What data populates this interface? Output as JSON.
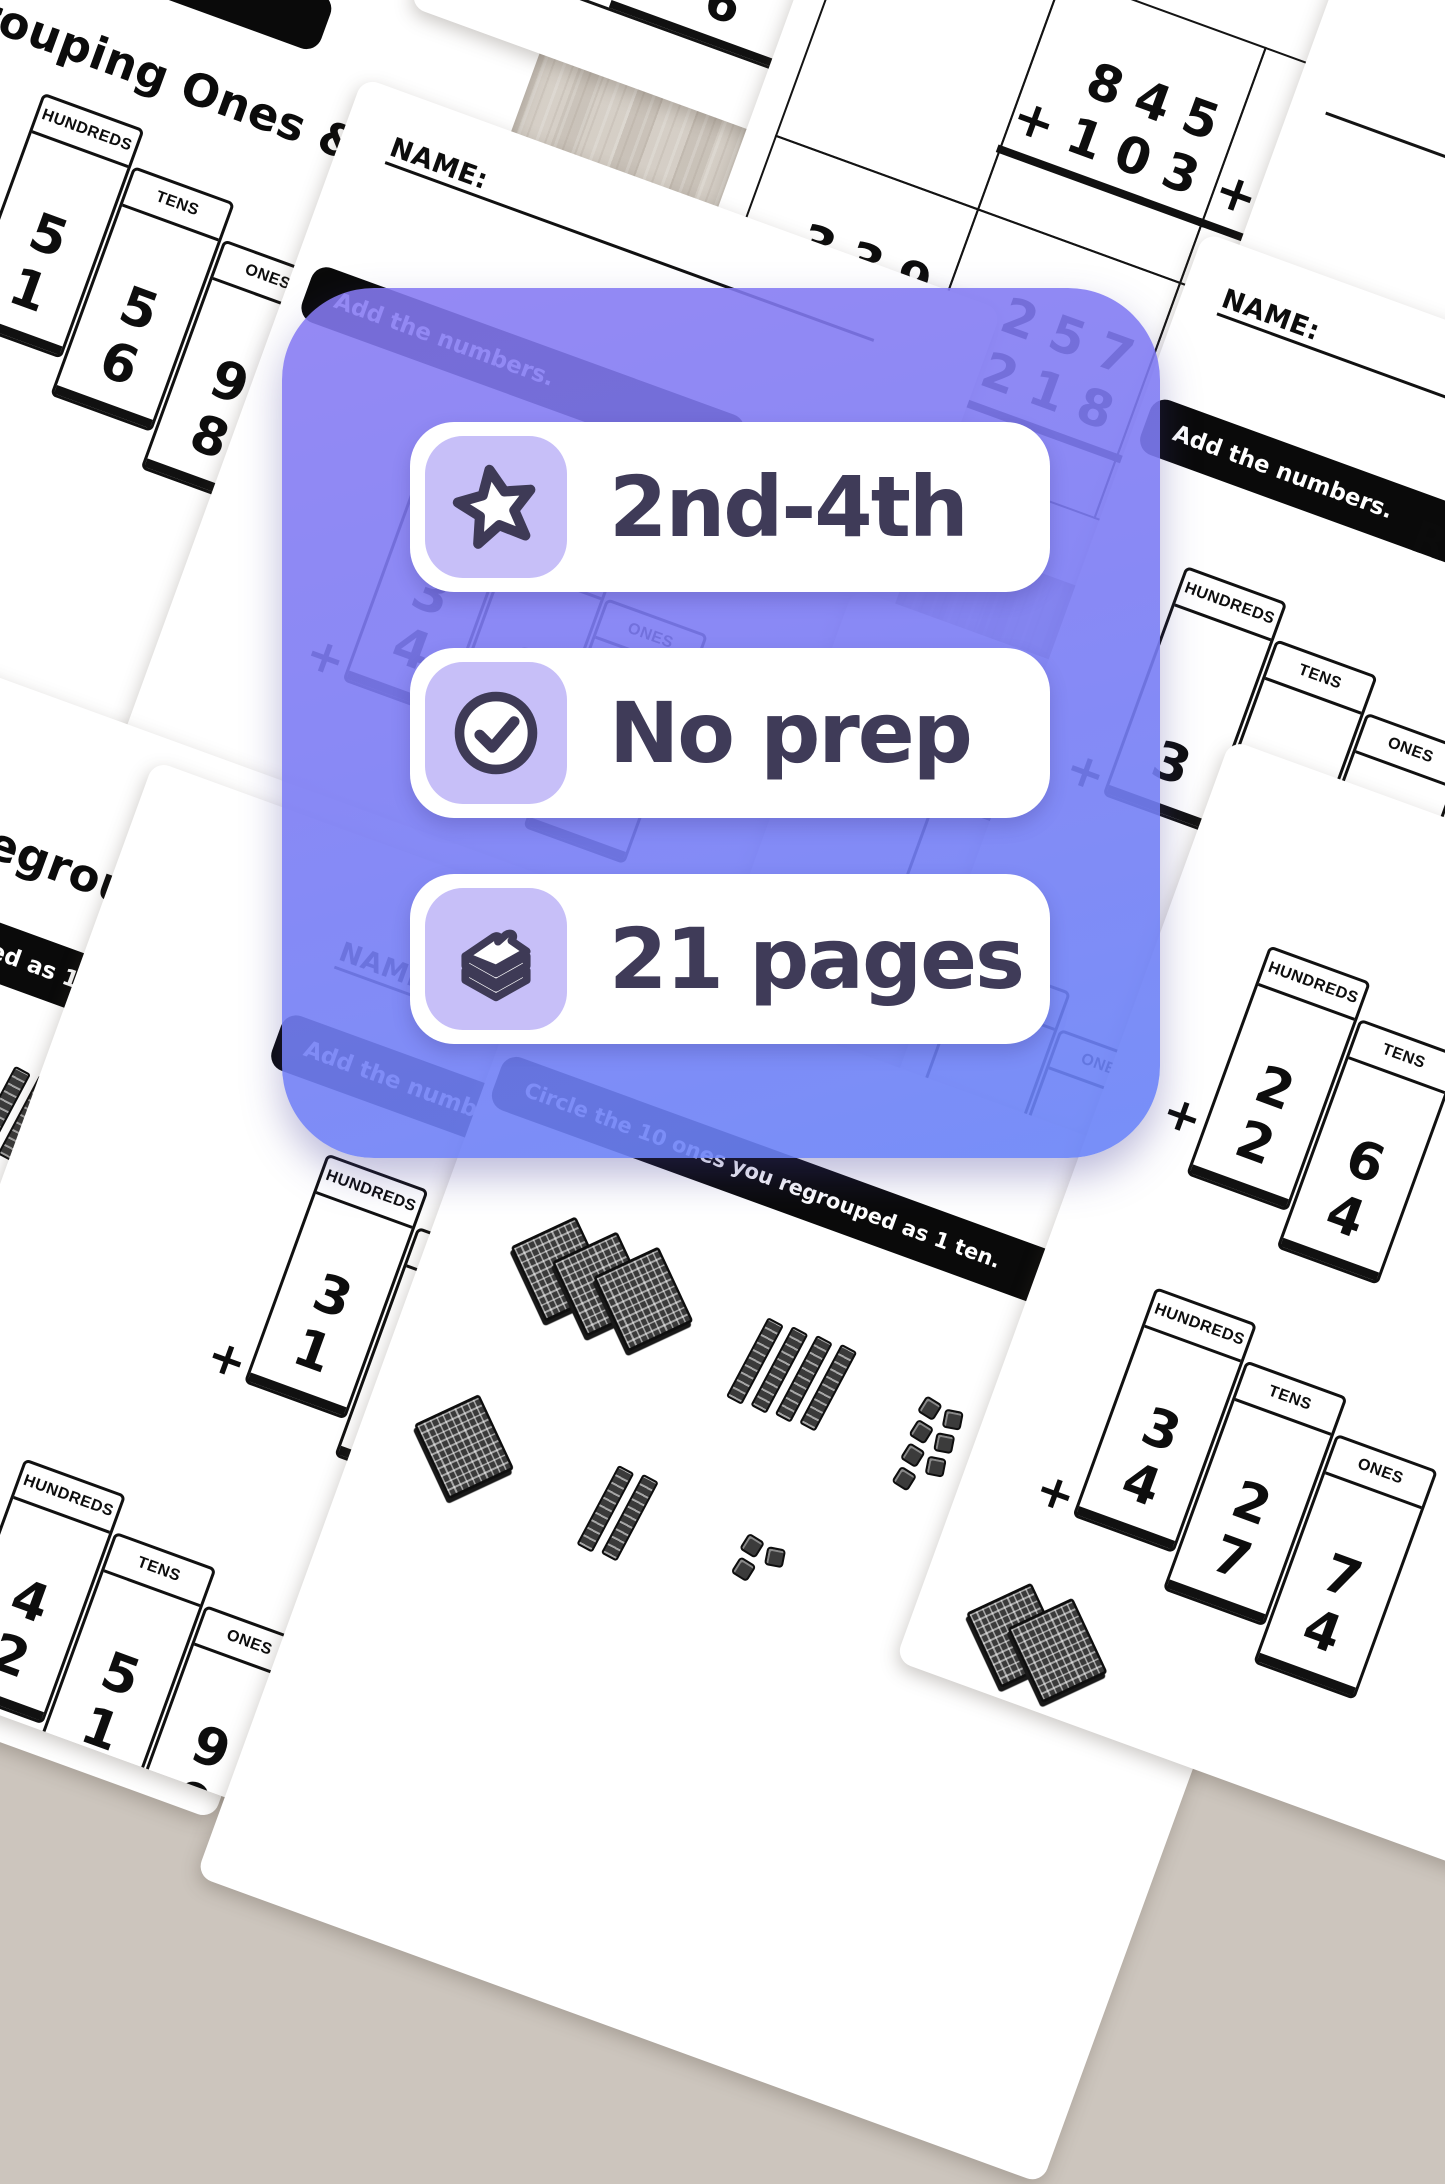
{
  "overlay": {
    "badges": [
      {
        "icon": "star-icon",
        "label": "2nd-4th"
      },
      {
        "icon": "check-circle-icon",
        "label": "No prep"
      },
      {
        "icon": "pages-stack-icon",
        "label": "21 pages"
      }
    ],
    "colors": {
      "card_top": "#8679f2",
      "card_bottom": "#6883f7",
      "icon_tile": "#c7bff8",
      "badge_text": "#3f3b58",
      "badge_bg": "#ffffff",
      "ink": "#0d0d0d",
      "banner_bg": "#0a0a0a"
    }
  },
  "worksheet": {
    "name_label": "NAME:",
    "plus": "+",
    "headers": {
      "hundreds": "HUNDREDS",
      "tens": "TENS",
      "ones": "ONES"
    },
    "banners": {
      "add": "Add the numbers.",
      "circle": "Circle the 10 ones you regrouped as 1 ten.",
      "hundred": "regrouped as 1 hundred."
    },
    "titles": {
      "ones_tens": "Regrouping Ones & Tens",
      "ones": "Regrouping Ones"
    },
    "sheets": {
      "s1": {
        "table_a": {
          "rows": [
            [
              "5",
              "5",
              "9"
            ],
            [
              "1",
              "6",
              "8"
            ]
          ]
        },
        "table_b": {
          "rows": [
            [
              "8",
              "9"
            ],
            [
              "",
              "1"
            ]
          ]
        }
      },
      "s2": {
        "table_a": {
          "rows": [
            [
              "3",
              "6",
              "5"
            ],
            [
              "4",
              "7",
              "7"
            ]
          ]
        }
      },
      "s3": {
        "digits": "5 6 8"
      },
      "s4": {
        "problems": [
          {
            "top": "845",
            "bottom": "+103"
          },
          {
            "top": "357",
            "bottom": "+458"
          },
          {
            "top": "339",
            "bottom": "+285"
          },
          {
            "top": "257",
            "bottom": "+218"
          },
          {
            "top": "412",
            "bottom": "+263"
          }
        ]
      },
      "s5": {
        "table_a": {
          "rows": [
            [
              "3",
              "1",
              "9"
            ],
            [
              "",
              "2",
              "8"
            ]
          ]
        },
        "table_b": {
          "rows": [
            [
              "",
              "6"
            ],
            [
              "1",
              "3"
            ]
          ]
        }
      },
      "s7": {
        "table_a": {
          "rows": [
            [
              "2",
              "6"
            ],
            [
              "2",
              "4"
            ]
          ]
        },
        "table_b": {
          "rows": [
            [
              "3",
              "2",
              "7"
            ],
            [
              "4",
              "7",
              "4"
            ]
          ]
        }
      },
      "s9": {
        "table_a": {
          "rows": [
            [
              "3",
              "4",
              "8"
            ],
            [
              "1",
              "2",
              "5"
            ]
          ]
        },
        "table_b": {
          "rows": [
            [
              "4",
              "5",
              "9"
            ],
            [
              "2",
              "1",
              "0"
            ]
          ]
        }
      },
      "s10": {
        "problem": {
          "top": "31",
          "bottom": "+45"
        }
      },
      "s11": {
        "table_a": {
          "rows": [
            [
              "4",
              "0",
              "7"
            ],
            [
              "4",
              "6",
              "7"
            ]
          ]
        }
      }
    }
  }
}
